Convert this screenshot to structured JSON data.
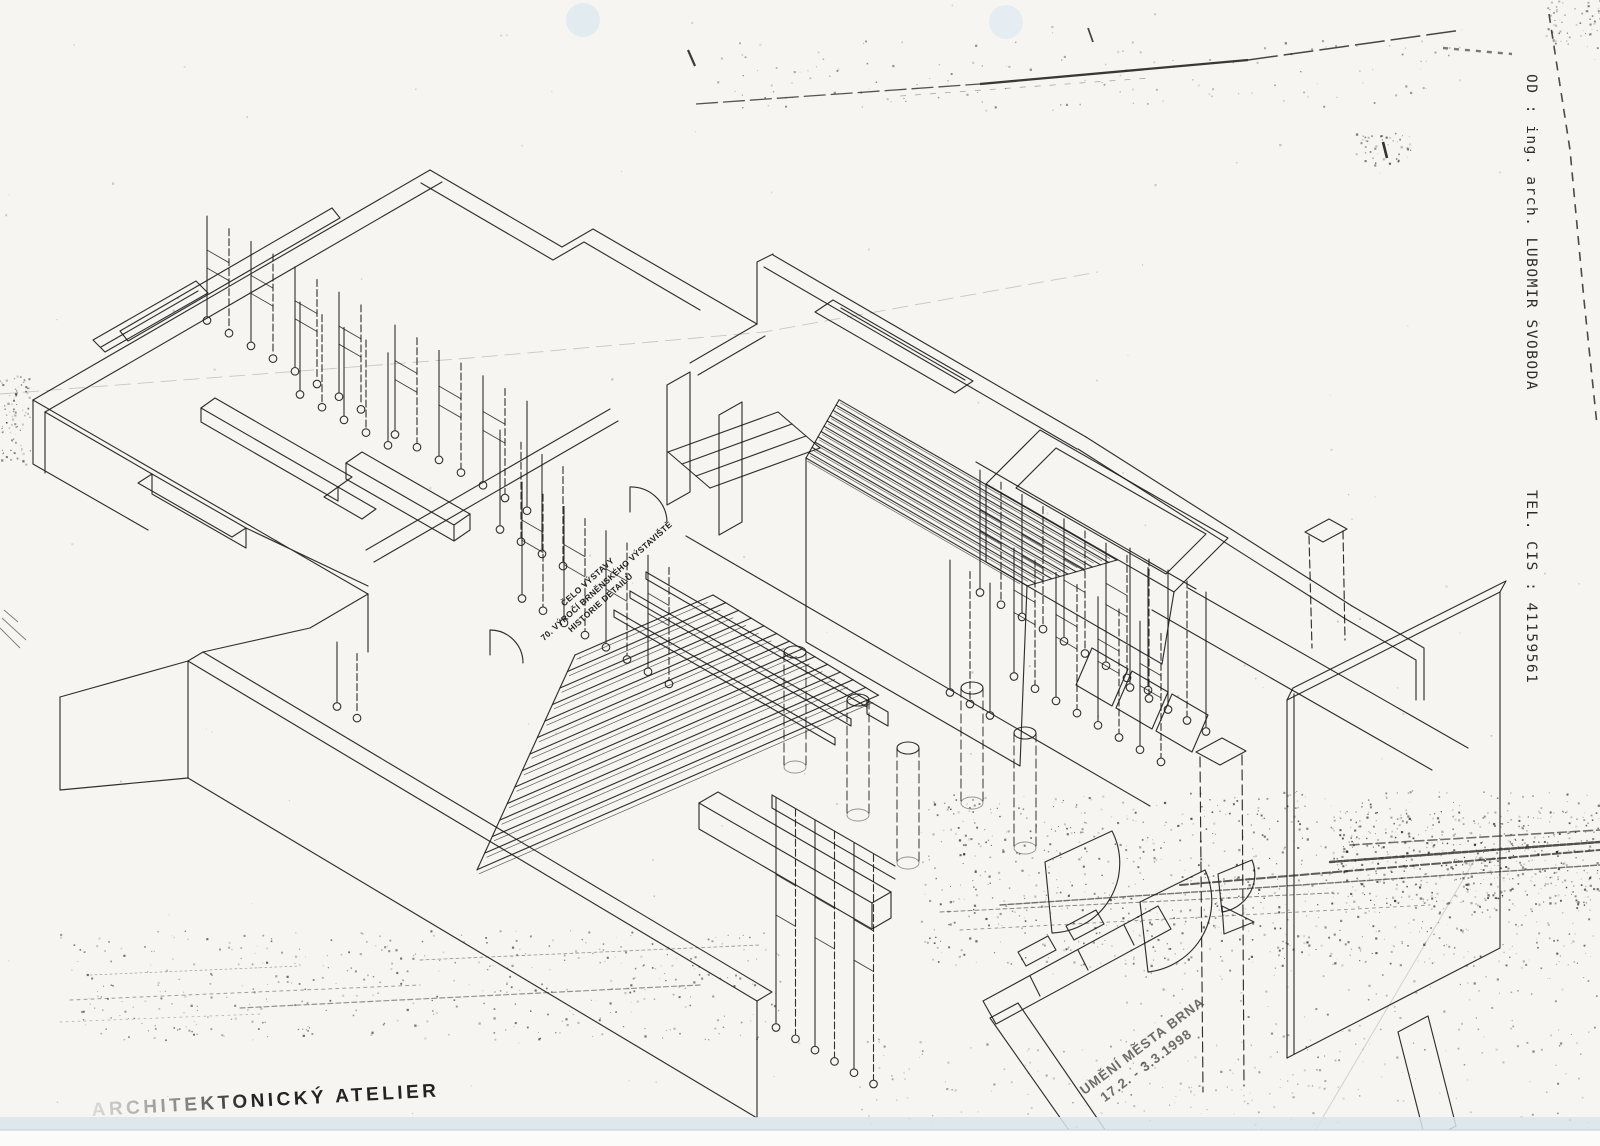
{
  "fax_header": {
    "from": "OD : ing. arch. LUBOMIR SVOBODA",
    "tel": "TEL.   CIS : 41159561"
  },
  "drawing_annotation": {
    "line1": "ČELO VÝSTAVY",
    "line2": "70. VÝROČÍ BRNĚNSKÉHO VÝSTAVIŠTĚ",
    "line3": "HISTORIE DETAILŮ"
  },
  "date_stamp": {
    "line1": "UMĚNÍ MĚSTA BRNA",
    "line2": "17.2. - 3.3.1998"
  },
  "studio_stamp": {
    "text": "ARCHITEKTONICKÝ ATELIER"
  },
  "colors": {
    "paper": "#f6f5f1",
    "ink": "#1b1b1b",
    "punch_hole": "#e2ebf0",
    "scanner_band": "#d9e4ea"
  }
}
